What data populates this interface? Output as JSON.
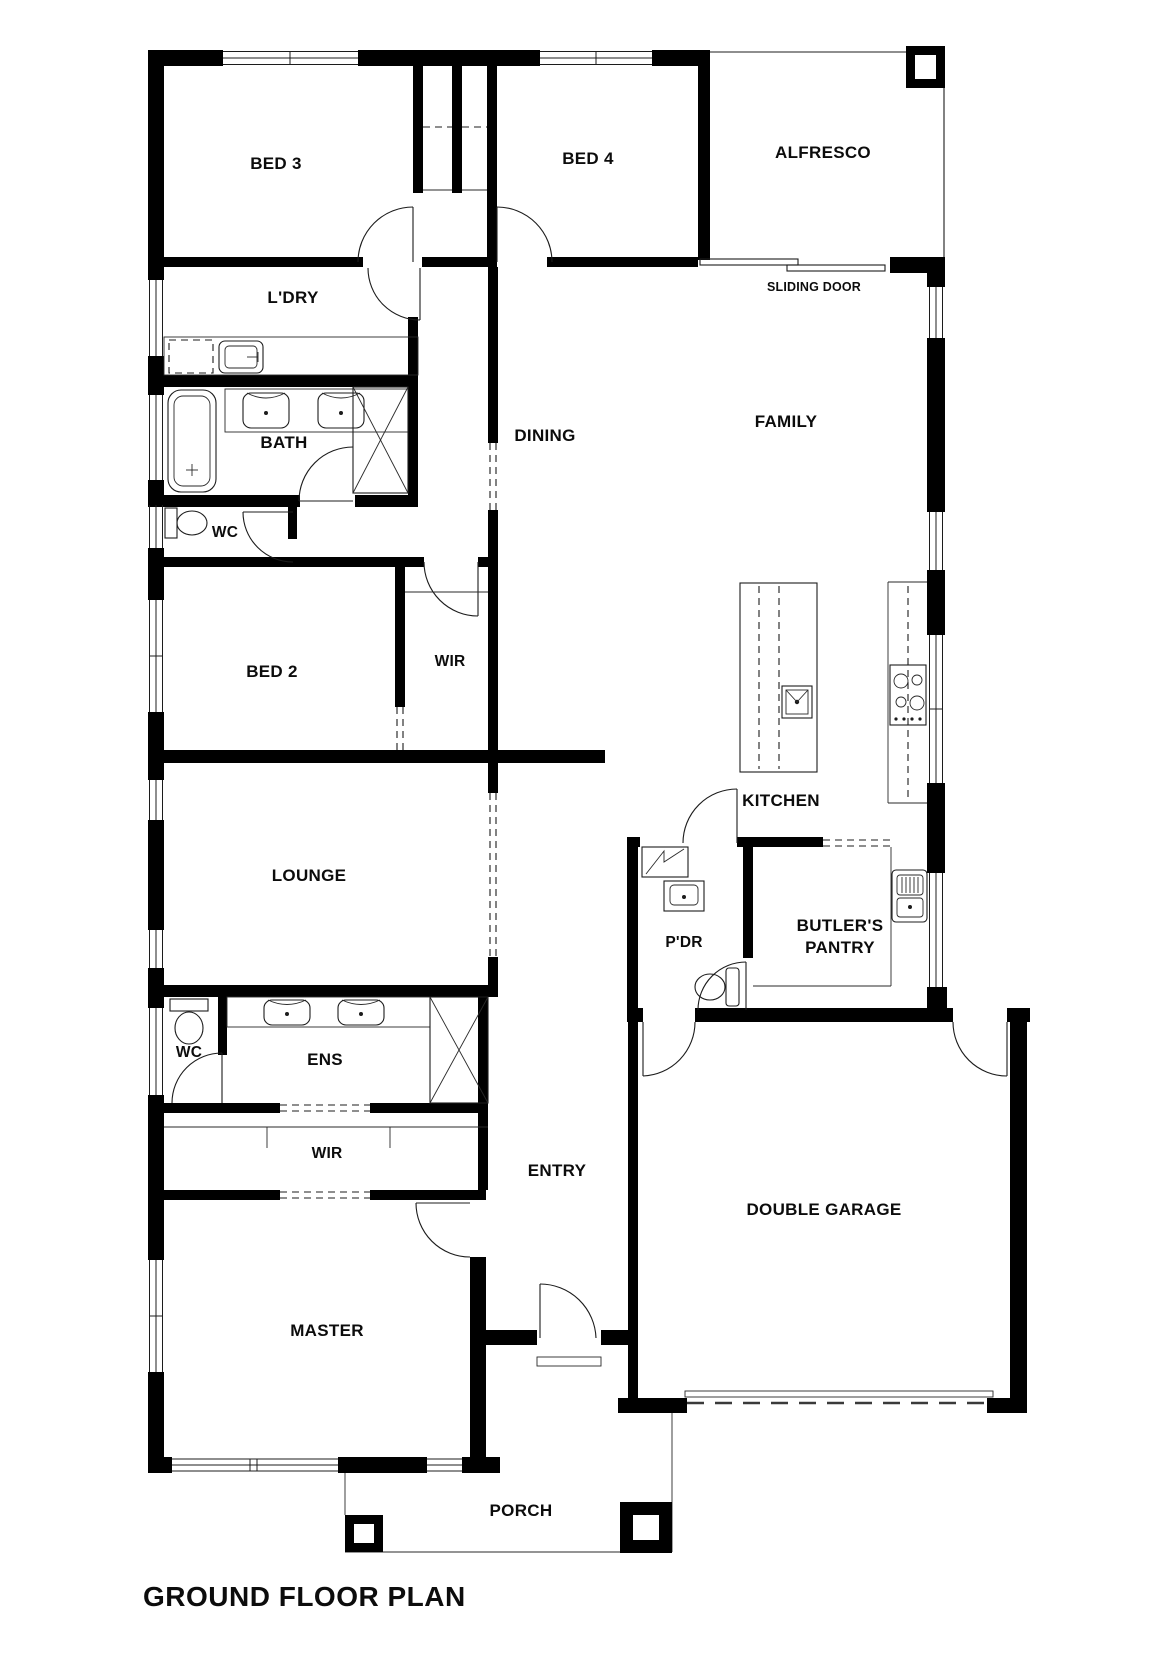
{
  "plan": {
    "title": "GROUND FLOOR PLAN",
    "colors": {
      "wall": "#000000",
      "background": "#ffffff",
      "line": "#1c1c1c"
    },
    "labels": {
      "bed3": "BED 3",
      "bed4": "BED 4",
      "alfresco": "ALFRESCO",
      "sliding_door": "SLIDING DOOR",
      "laundry": "L'DRY",
      "dining": "DINING",
      "family": "FAMILY",
      "bath": "BATH",
      "wc_upper": "WC",
      "bed2": "BED 2",
      "wir_upper": "WIR",
      "kitchen": "KITCHEN",
      "lounge": "LOUNGE",
      "powder": "P'DR",
      "butlers_line1": "BUTLER'S",
      "butlers_line2": "PANTRY",
      "wc_lower": "WC",
      "ensuite": "ENS",
      "wir_lower": "WIR",
      "entry": "ENTRY",
      "garage": "DOUBLE GARAGE",
      "master": "MASTER",
      "porch": "PORCH"
    }
  }
}
